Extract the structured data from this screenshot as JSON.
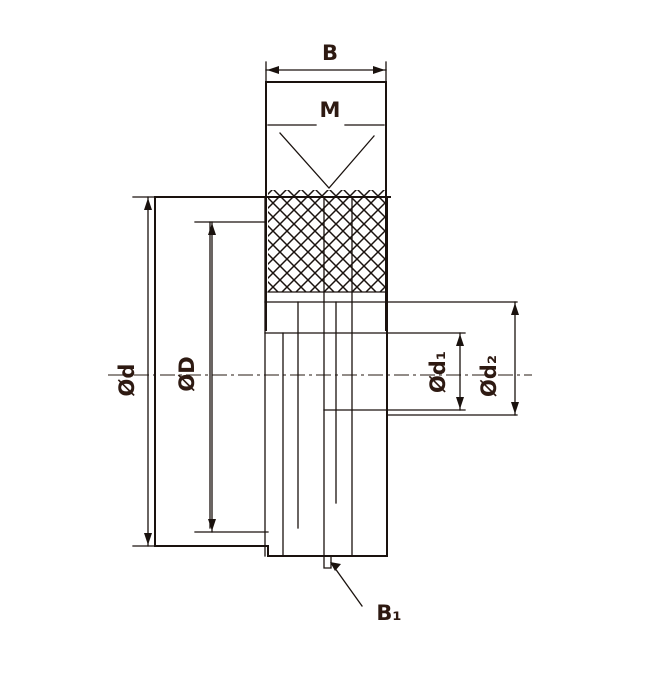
{
  "drawing": {
    "description": "Sectional technical drawing of a threaded part with knurled section and diameter dimensions",
    "labels": {
      "top_width": "B",
      "thread": "M",
      "left_outer_diameter": "Ød",
      "left_inner_diameter": "ØD",
      "right_inner_diameter": "Ød₁",
      "right_outer_diameter": "Ød₂",
      "bottom_length": "B₁"
    },
    "colors": {
      "line": "#1a120e",
      "label": "#2e1a12",
      "background": "#ffffff"
    }
  }
}
